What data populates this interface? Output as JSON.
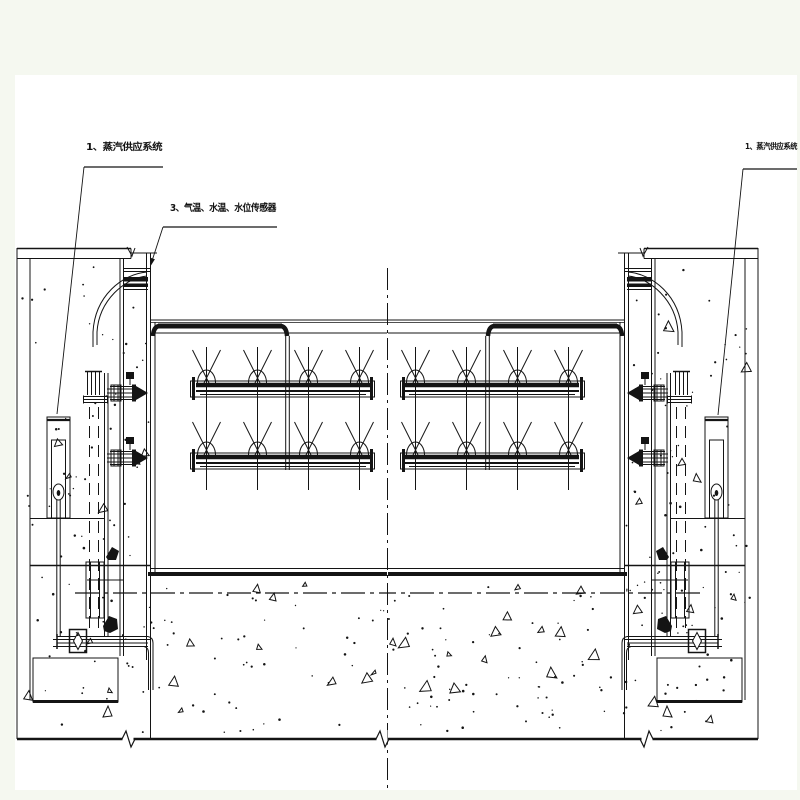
{
  "drawing": {
    "colors": {
      "background": "#f5f8f0",
      "paper": "#ffffff",
      "ink": "#141414"
    },
    "labels": {
      "steam_system_left": {
        "text": "1、蒸汽供应系统"
      },
      "sensors": {
        "text": "3、气温、水温、水位传感器"
      },
      "steam_system_right": {
        "text": "1、蒸汽供应系统"
      }
    }
  }
}
